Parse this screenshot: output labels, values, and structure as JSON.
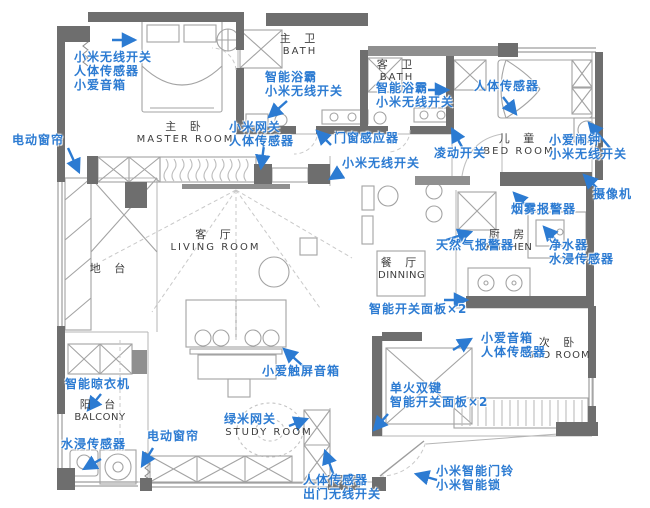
{
  "colors": {
    "label_blue": "#2c7bd2",
    "wall_dark": "#6e6e6e",
    "wall_mid": "#8f8f8f",
    "furniture_line": "#a3a3a3",
    "room_text": "#3e3e3e"
  },
  "rooms": {
    "master": {
      "zh": "主  卧",
      "en": "MASTER  ROOM"
    },
    "master_bath": {
      "zh": "主 卫",
      "en": "BATH"
    },
    "guest_bath": {
      "zh": "客 卫",
      "en": "BATH"
    },
    "kids": {
      "zh": "儿 童",
      "en": "BED  ROOM"
    },
    "living": {
      "zh": "客 厅",
      "en": "LIVING  ROOM"
    },
    "platform": {
      "zh": "地 台",
      "en": ""
    },
    "dining": {
      "zh": "餐 厅",
      "en": "DINNING"
    },
    "kitchen": {
      "zh": "厨 房",
      "en": "KITCHEN"
    },
    "second": {
      "zh": "次  卧",
      "en": "BED  ROOM"
    },
    "study": {
      "zh": "",
      "en": "STUDY  ROOM"
    },
    "balcony": {
      "zh": "阳 台",
      "en": "BALCONY"
    }
  },
  "devices": {
    "master_group": {
      "lines": [
        "小米无线开关",
        "人体传感器",
        "小爱音箱"
      ]
    },
    "curtain_master": {
      "lines": [
        "电动窗帘"
      ]
    },
    "master_bath_group": {
      "lines": [
        "智能浴霸",
        "小米无线开关"
      ]
    },
    "gateway_group": {
      "lines": [
        "小米网关",
        "人体传感器"
      ]
    },
    "door_window_sensor": {
      "lines": [
        "门窗感应器"
      ]
    },
    "wireless_switch_tv": {
      "lines": [
        "小米无线开关"
      ]
    },
    "guest_bath_group": {
      "lines": [
        "智能浴霸",
        "小米无线开关"
      ]
    },
    "lingdong_switch": {
      "lines": [
        "凌动开关"
      ]
    },
    "body_sensor_kids": {
      "lines": [
        "人体传感器"
      ]
    },
    "clock_group": {
      "lines": [
        "小爱闹钟",
        "小米无线开关"
      ]
    },
    "camera": {
      "lines": [
        "摄像机"
      ]
    },
    "smoke_alarm": {
      "lines": [
        "烟雾报警器"
      ]
    },
    "gas_alarm": {
      "lines": [
        "天然气报警器"
      ]
    },
    "purifier_group": {
      "lines": [
        "净水器",
        "水浸传感器"
      ]
    },
    "switch_panel_dining": {
      "lines": [
        "智能开关面板×2"
      ]
    },
    "speaker_second_group": {
      "lines": [
        "小爱音箱",
        "人体传感器"
      ]
    },
    "single_fire_group": {
      "lines": [
        "单火双键",
        "智能开关面板×2"
      ]
    },
    "touchscreen_speaker": {
      "lines": [
        "小爱触屏音箱"
      ]
    },
    "lumi_gateway": {
      "lines": [
        "绿米网关"
      ]
    },
    "curtain_study": {
      "lines": [
        "电动窗帘"
      ]
    },
    "clothes_dryer": {
      "lines": [
        "智能晾衣机"
      ]
    },
    "water_leak_balcony": {
      "lines": [
        "水浸传感器"
      ]
    },
    "exit_group": {
      "lines": [
        "人体传感器",
        "出门无线开关"
      ]
    },
    "doorbell_group": {
      "lines": [
        "小米智能门铃",
        "小米智能锁"
      ]
    }
  }
}
